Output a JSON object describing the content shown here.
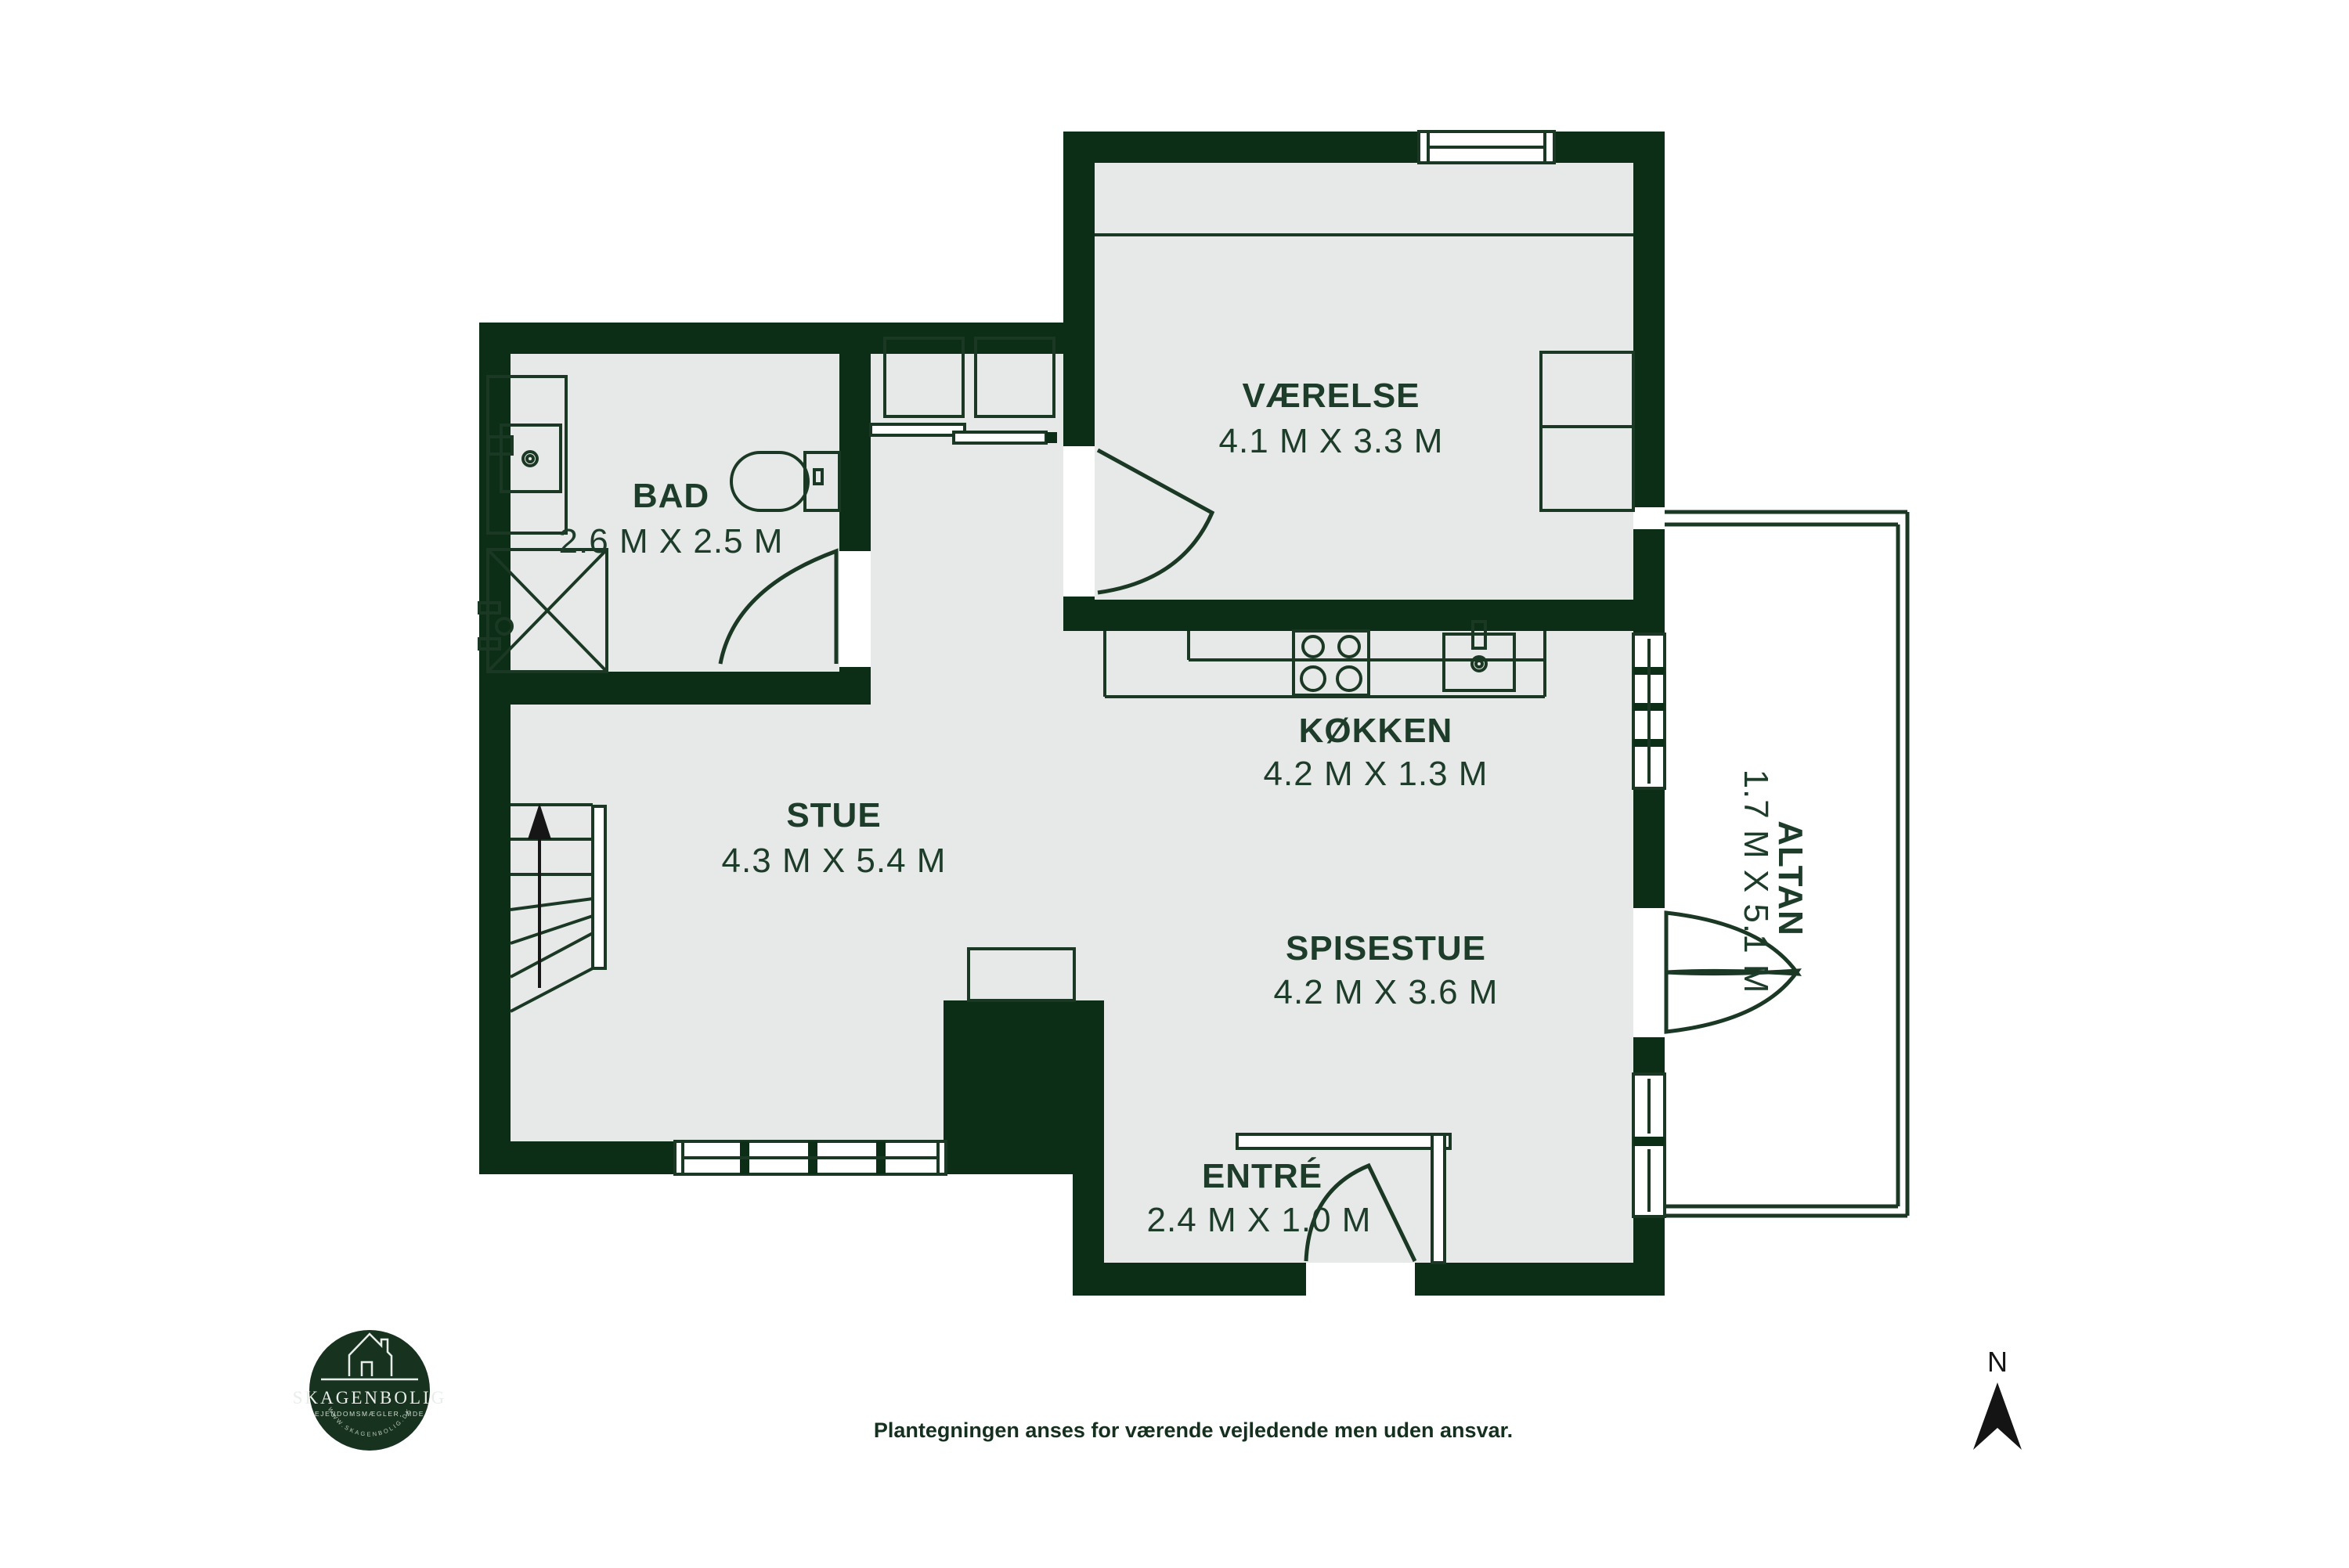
{
  "colors": {
    "wall": "#0c2d16",
    "floor": "#e6e9e7",
    "line": "#1b3824",
    "label": "#1e3c2a",
    "disclaimer": "#15301e",
    "logo": "#17331f",
    "background": "#ffffff"
  },
  "plan": {
    "rooms": [
      {
        "id": "vaerelse",
        "name": "VÆRELSE",
        "dims": "4.1 M X 3.3 M"
      },
      {
        "id": "bad",
        "name": "BAD",
        "dims": "2.6 M X 2.5 M"
      },
      {
        "id": "koekken",
        "name": "KØKKEN",
        "dims": "4.2 M X 1.3 M"
      },
      {
        "id": "stue",
        "name": "STUE",
        "dims": "4.3 M X 5.4 M"
      },
      {
        "id": "spisestue",
        "name": "SPISESTUE",
        "dims": "4.2 M X 3.6 M"
      },
      {
        "id": "entre",
        "name": "ENTRÉ",
        "dims": "2.4 M X 1.0 M"
      },
      {
        "id": "altan",
        "name": "ALTAN",
        "dims": "1.7 M X 5.1 M"
      }
    ]
  },
  "compass": {
    "north_label": "N"
  },
  "branding": {
    "name": "SKAGENBOLIG",
    "subtitle": "EJENDOMSMÆGLER, MDE",
    "website": "WWW.SKAGENBOLIG.DK"
  },
  "footer": {
    "disclaimer": "Plantegningen anses for værende vejledende men uden ansvar."
  }
}
